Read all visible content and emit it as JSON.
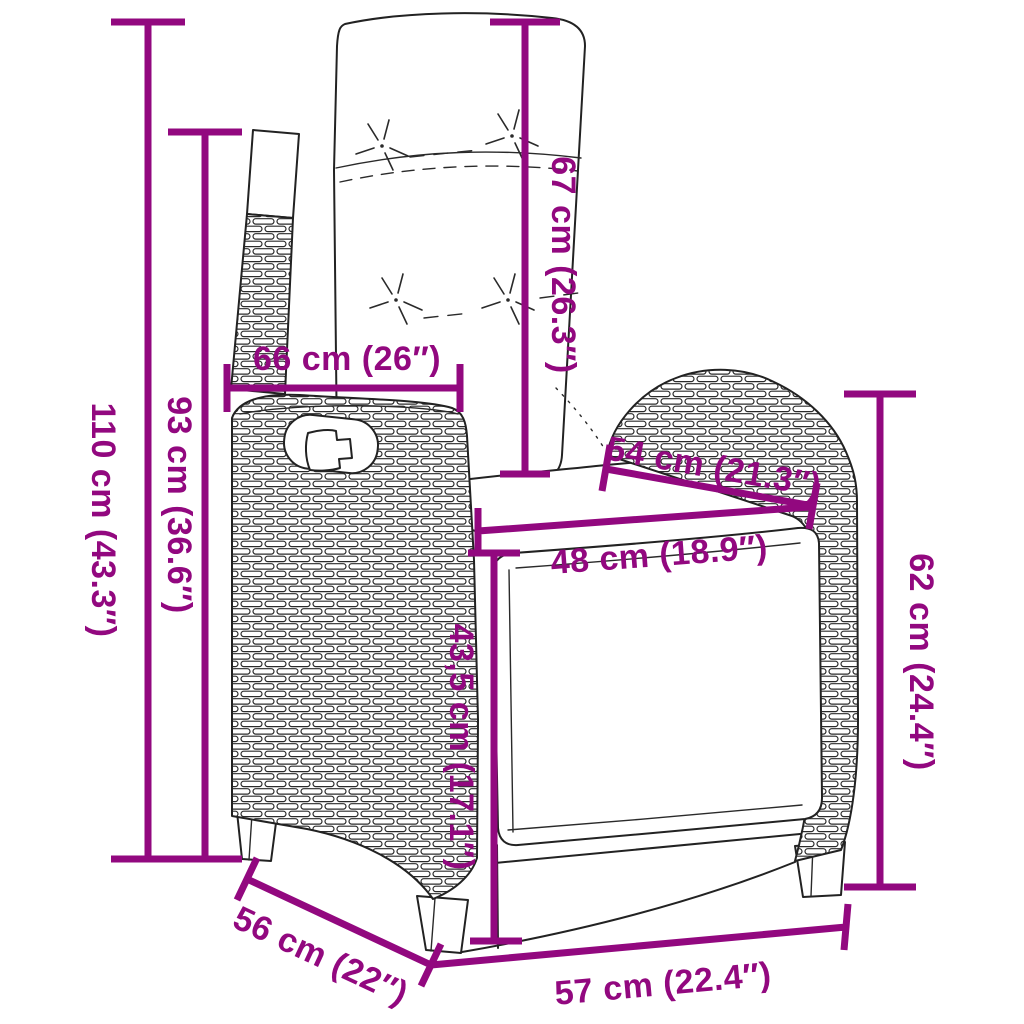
{
  "accent_color": "#92087f",
  "diagram": {
    "subject": "reclining-garden-chair-with-footrest-line-drawing",
    "style": "poly-rattan wicker outline illustration with cushions"
  },
  "dimensions": [
    {
      "id": "total-height",
      "cm": "110",
      "inch": "43.3",
      "label": "110 cm (43.3″)",
      "orientation": "vertical"
    },
    {
      "id": "backrest-height",
      "cm": "93",
      "inch": "36.6",
      "label": "93 cm (36.6″)",
      "orientation": "vertical"
    },
    {
      "id": "backrest-width",
      "cm": "66",
      "inch": "26",
      "label": "66 cm (26″)",
      "orientation": "horizontal"
    },
    {
      "id": "back-cushion-length",
      "cm": "67",
      "inch": "26.3",
      "label": "67 cm (26.3″)",
      "orientation": "vertical"
    },
    {
      "id": "armrest-length",
      "cm": "54",
      "inch": "21.3",
      "label": "54 cm (21.3″)",
      "orientation": "diagonal"
    },
    {
      "id": "seat-width",
      "cm": "48",
      "inch": "18.9",
      "label": "48 cm (18.9″)",
      "orientation": "horizontal"
    },
    {
      "id": "footrest-height",
      "cm": "43,5",
      "inch": "17.1",
      "label": "43,5 cm (17.1″)",
      "orientation": "vertical"
    },
    {
      "id": "side-height",
      "cm": "62",
      "inch": "24.4",
      "label": "62 cm (24.4″)",
      "orientation": "vertical"
    },
    {
      "id": "seat-depth",
      "cm": "56",
      "inch": "22",
      "label": "56 cm (22″)",
      "orientation": "diagonal"
    },
    {
      "id": "front-width",
      "cm": "57",
      "inch": "22.4",
      "label": "57 cm (22.4″)",
      "orientation": "horizontal"
    }
  ]
}
